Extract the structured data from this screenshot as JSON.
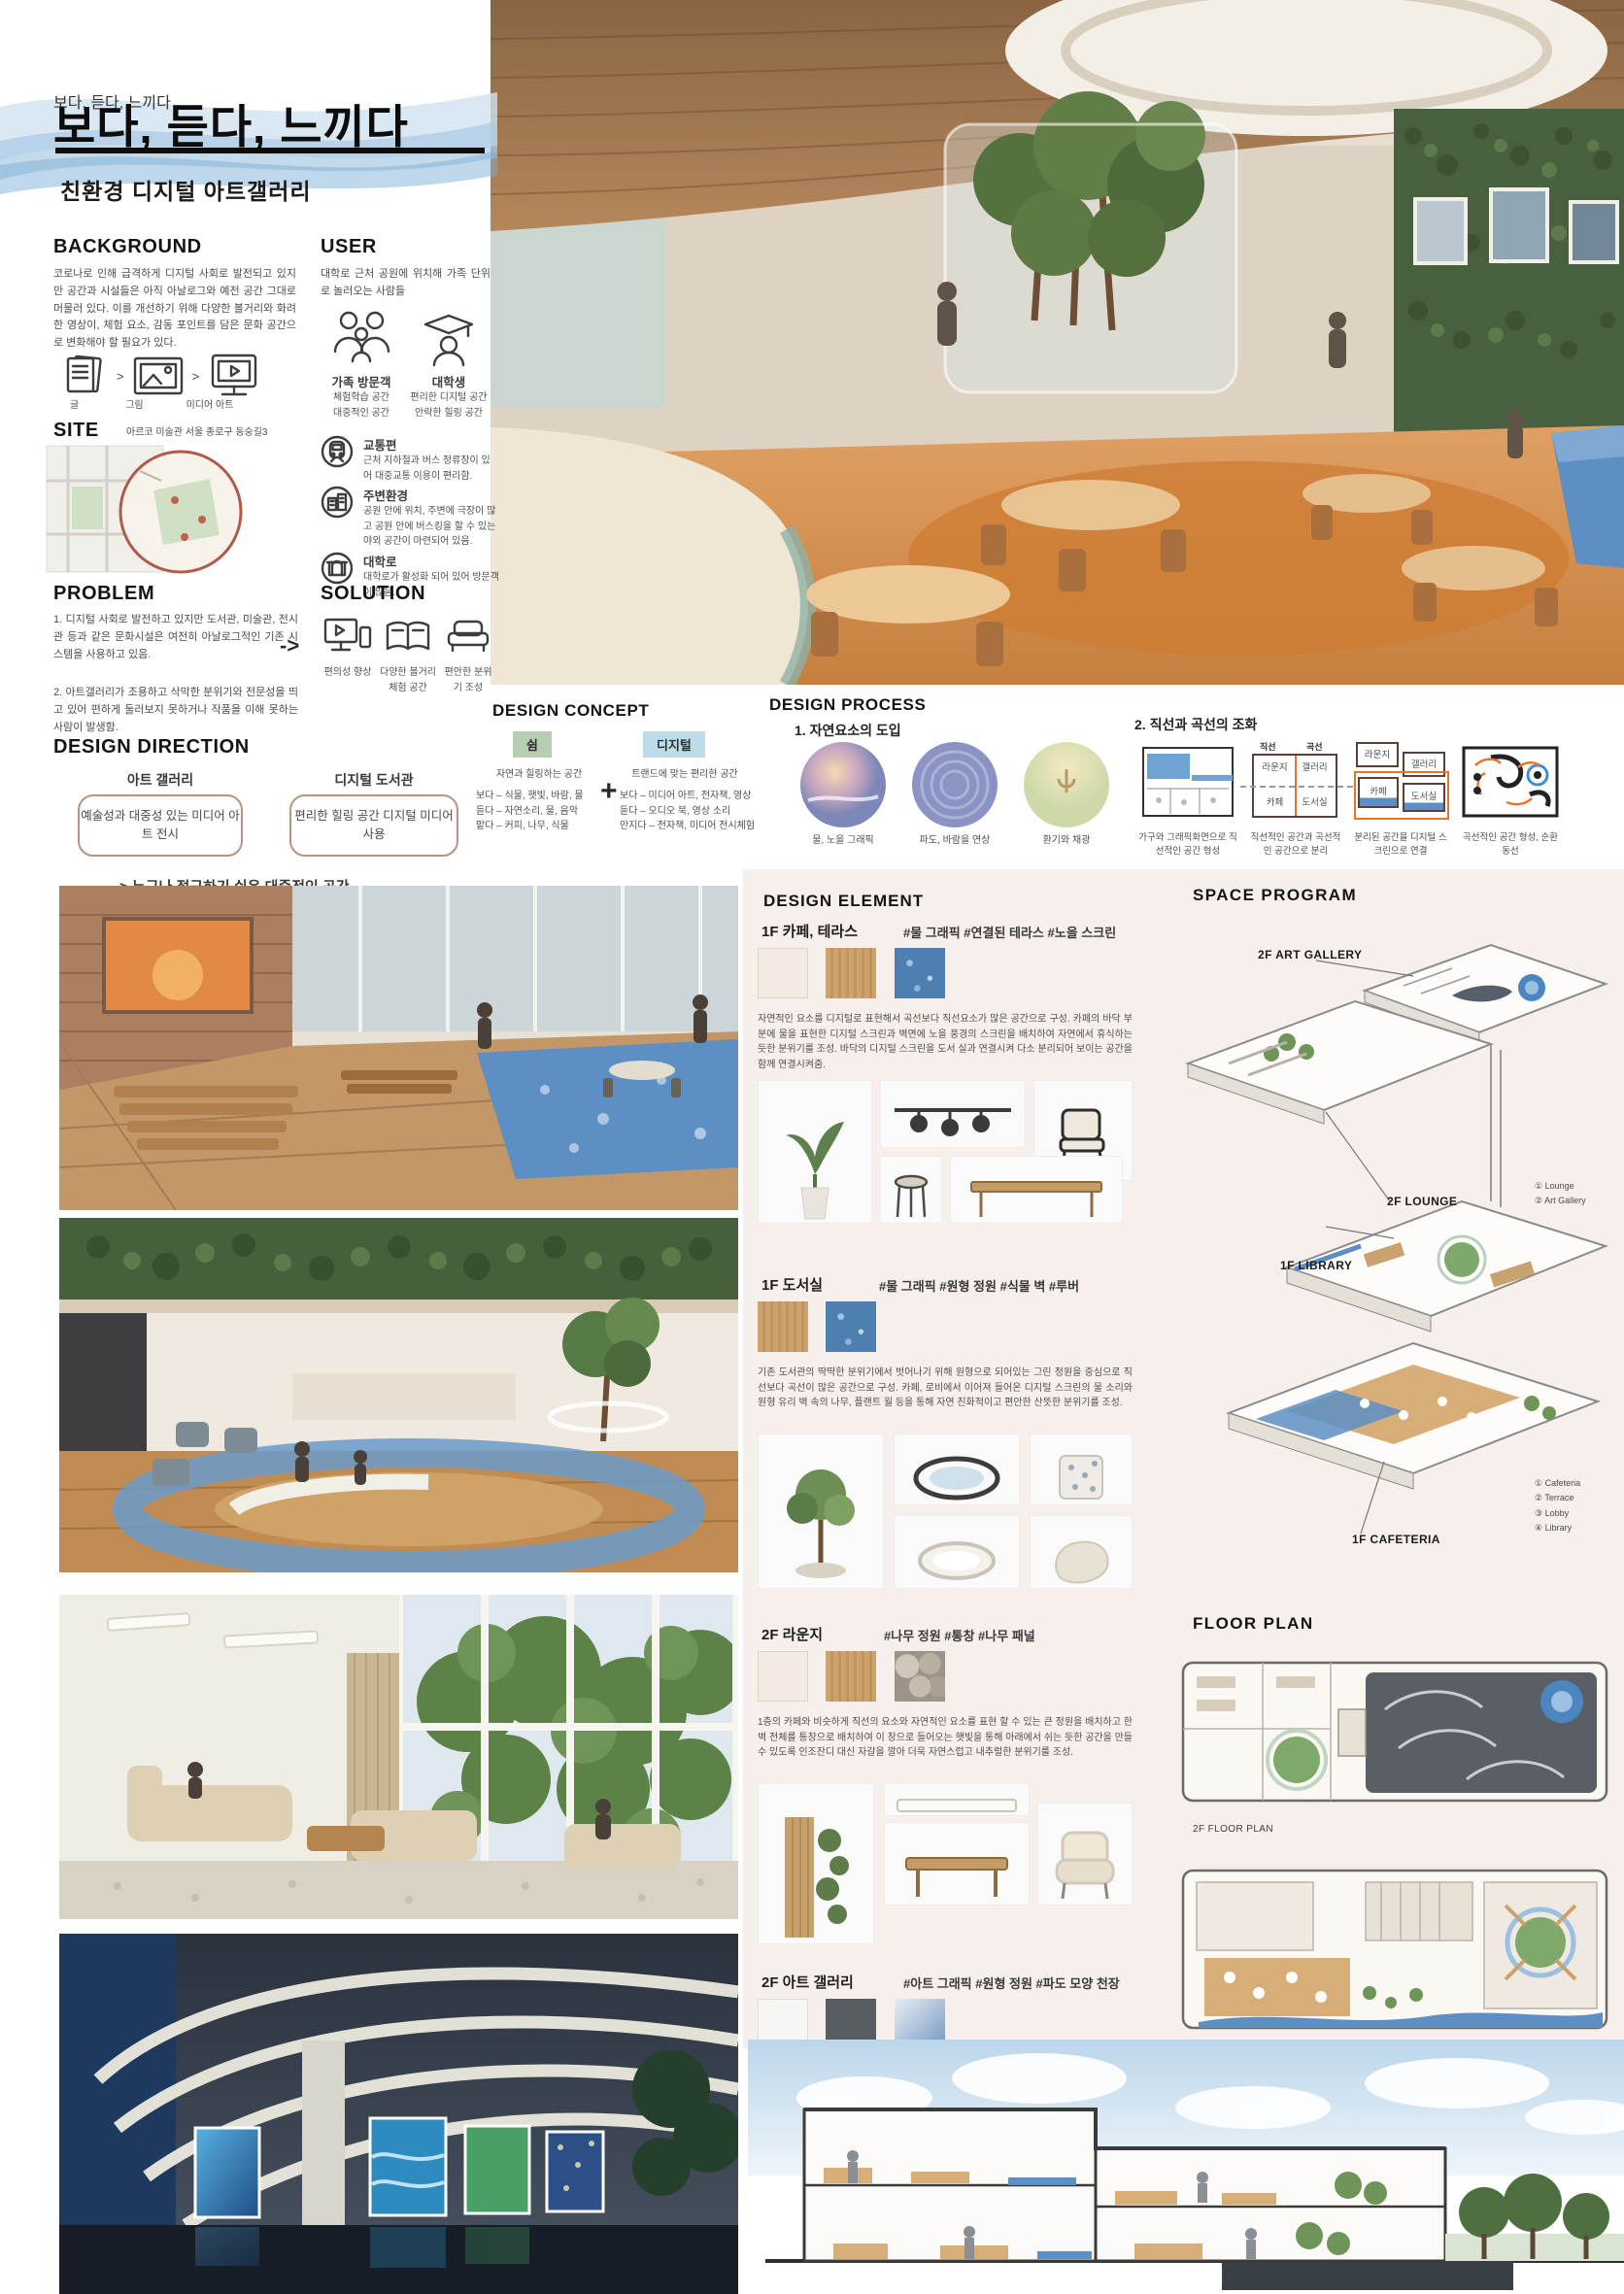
{
  "header": {
    "title": "보다, 듣다, 느끼다",
    "subtitle": "친환경 디지털 아트갤러리"
  },
  "background": {
    "heading": "BACKGROUND",
    "body": "코로나로 인해 급격하게 디지털 사회로 발전되고 있지만 공간과 시설들은 아직 아날로그와 예전 공간 그대로 머물러 있다. 이를 개선하기 위해 다양한 볼거리와 화려한 영상이, 체험 요소, 감동 포인트를 담은 문화 공간으로 변화해야 할 필요가 있다.",
    "sep": ">",
    "steps": [
      {
        "label": "글"
      },
      {
        "label": "그림"
      },
      {
        "label": "미디어 아트"
      }
    ]
  },
  "user": {
    "heading": "USER",
    "body": "대학로 근처 공원에 위치해 가족 단위로 놀러오는 사람들",
    "personas": [
      {
        "name": "가족 방문객",
        "trait1": "체험학습 공간",
        "trait2": "대중적인 공간"
      },
      {
        "name": "대학생",
        "trait1": "편리한 디지털 공간",
        "trait2": "안락한 힐링 공간"
      }
    ]
  },
  "site": {
    "heading": "SITE",
    "address": "아르코 미술관  서울 종로구 동숭길3",
    "features": [
      {
        "title": "교통편",
        "body": "근처 지하철과 버스 정류장이 있어 대중교통 이용이 편리함."
      },
      {
        "title": "주변환경",
        "body": "공원 안에 위치, 주변에 극장이 많고 공원 안에 버스킹을 할 수 있는 야외 공간이 마련되어 있음."
      },
      {
        "title": "대학로",
        "body": "대학로가 활성화 되어 있어 방문객이 많음."
      }
    ]
  },
  "problem": {
    "heading": "PROBLEM",
    "item1": "1. 디지털 사회로 발전하고 있지만 도서관, 미술관, 전시관 등과 같은 문화시설은 여전히 아날로그적인 기존 시스템을 사용하고 있음.",
    "item2": "2. 아트갤러리가 조용하고 삭막한 분위기와 전문성을 띄고 있어 편하게 둘러보지 못하거나 작품을 이해 못하는 사람이 발생함."
  },
  "solution": {
    "heading": "SOLUTION",
    "arrow": "->",
    "items": [
      {
        "label": "편의성 향상"
      },
      {
        "label": "다양한 볼거리 체험 공간"
      },
      {
        "label": "편안한 분위기 조성"
      }
    ]
  },
  "design_direction": {
    "heading": "DESIGN DIRECTION",
    "col1": {
      "title": "아트 갤러리",
      "box": "예술성과 대중성 있는 미디어 아트 전시"
    },
    "col2": {
      "title": "디지털 도서관",
      "box": "편리한 힐링 공간 디지털 미디어 사용"
    },
    "result": "-> 누구나 접근하기 쉬운 대중적인 공간"
  },
  "design_concept": {
    "heading": "DESIGN CONCEPT",
    "plus": "+",
    "rest": {
      "badge": "쉼",
      "subtitle": "자연과 힐링하는 공간",
      "line1": "보다 – 식물, 햇빛, 바람, 물",
      "line2": "듣다 – 자연소리, 물, 음악",
      "line3": "맡다 – 커피, 나무, 식물"
    },
    "digital": {
      "badge": "디지털",
      "subtitle": "트랜드에 맞는 편리한 공간",
      "line1": "보다 – 미디어 아트, 전자책, 영상",
      "line2": "듣다 – 오디오 북, 영상 소리",
      "line3": "만지다 – 전자책, 미디어 전시체험"
    }
  },
  "design_process": {
    "heading": "DESIGN PROCESS",
    "step1": {
      "title": "1. 자연요소의 도입",
      "items": [
        {
          "caption": "물, 노을 그래픽"
        },
        {
          "caption": "파도, 바람을 연상"
        },
        {
          "caption": "환기와 채광"
        }
      ]
    },
    "step2": {
      "title": "2. 직선과 곡선의 조화",
      "col_straight": "직선",
      "col_curve": "곡선",
      "rooms": {
        "lounge": "라운지",
        "gallery": "갤러리",
        "cafe": "카페",
        "library": "도서실"
      },
      "captions": [
        {
          "text": "가구와 그래픽화면으로 직선적인 공간 형성"
        },
        {
          "text": "직선적인 공간과 곡선적인 공간으로 분리"
        },
        {
          "text": "분리된 공간을 디지털 스크린으로 연결"
        },
        {
          "text": "곡선적인 공간 형성, 순환 동선"
        }
      ]
    }
  },
  "design_element": {
    "heading": "DESIGN ELEMENT",
    "sections": [
      {
        "title": "1F 카페, 테라스",
        "tags": "#물 그래픽  #연결된 테라스  #노을 스크린",
        "body": "자연적인 요소를 디지털로 표현해서 곡선보다 직선요소가 많은 공간으로 구성. 카페의 바닥 부분에 물을 표현한 디지털 스크린과 벽면에 노을 풍경의 스크린을 배치하여 자연에서 휴식하는 듯한 분위기를 조성. 바닥의 디지털 스크린을 도서 실과 연결시켜 다소 분리되어 보이는 공간을 함께 연결시켜줌."
      },
      {
        "title": "1F 도서실",
        "tags": "#물 그래픽  #원형 정원  #식물 벽  #루버",
        "body": "기존 도서관의 딱딱한 분위기에서 벗어나기 위해 원형으로 되어있는 그린 정원을 중심으로 직선보다 곡선이 많은 공간으로 구성. 카페, 로비에서 이어져 들어온 디지털 스크린의 물 소리와 원형 유리 벽 속의 나무, 플랜트 월 등을 통해 자연 친화적이고 편안한 산뜻한 분위기를 조성."
      },
      {
        "title": "2F 라운지",
        "tags": "#나무 정원  #통창  #나무 패널",
        "body": "1층의 카페와 비슷하게 직선의 요소와 자연적인 요소를 표현 할 수 있는 큰 정원을 배치하고 한 벽 전체를 통창으로 배치하여 이 창으로 들어오는 햇빛을 통해 아래에서 쉬는 듯한 공간을 만들 수 있도록 인조잔디 대신 자갈을 깔아 더욱 자연스럽고 내추럴한 분위기를 조성."
      },
      {
        "title": "2F 아트 갤러리",
        "tags": "#아트 그래픽  #원형 정원  #파도 모양 천장",
        "body": "1층의 도서실에서 이어지는 원형 유리를 따라 부드러운 곡선으로 공간을 구성. 곡선의 벽들을 따라 미디어 아트를 전시. 사용자의 움직임에 따라 움직이는 체험형 터치스크린을 바닥과 벽에 설치하여 유리천장 그래픽 화면들이 풍부하게 보이도록 설치."
      }
    ]
  },
  "space_program": {
    "heading": "SPACE PROGRAM",
    "callout_art_gallery": "2F ART GALLERY",
    "callout_lounge": "2F LOUNGE",
    "callout_library": "1F LIBRARY",
    "callout_cafeteria": "1F CAFETERIA",
    "legend_2f": [
      {
        "label": "① Lounge"
      },
      {
        "label": "② Art Gallery"
      }
    ],
    "legend_1f": [
      {
        "label": "① Cafeteria"
      },
      {
        "label": "② Terrace"
      },
      {
        "label": "③ Lobby"
      },
      {
        "label": "④ Library"
      }
    ]
  },
  "floor_plan": {
    "heading": "FLOOR PLAN",
    "label_2f": "2F FLOOR PLAN",
    "label_1f": "1F FLOOR PLAN"
  },
  "colors": {
    "accent_orange": "#e8742c",
    "water_blue": "#5d8fc4",
    "badge_green": "#b7cdb2",
    "badge_blue": "#bddcea",
    "box_border": "#bb9180",
    "wave_blue": "#b8d4e8"
  }
}
